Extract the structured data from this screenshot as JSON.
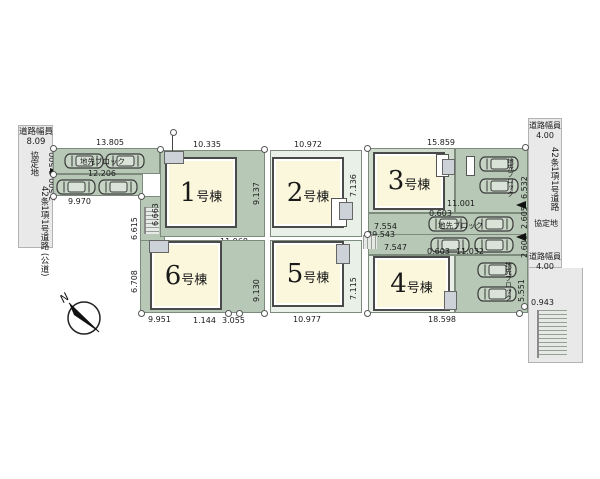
{
  "plan": {
    "compass_label": "N",
    "block_label": "地先ブロック",
    "roads": {
      "left": {
        "width_label": "道路幅員",
        "width_value": "8.09",
        "agreement": "協定地",
        "name": "42条1項1号道路",
        "name_suffix": "(公道)",
        "setback_a": "2.500",
        "setback_b": "2.500"
      },
      "right": {
        "width_label": "道路幅員",
        "width_value": "4.00",
        "agreement": "協定地",
        "name": "42条1項1号道路",
        "width_label2": "道路幅員",
        "width_value2": "4.00"
      }
    },
    "buildings": [
      {
        "num": "1",
        "suffix": "号棟"
      },
      {
        "num": "2",
        "suffix": "号棟"
      },
      {
        "num": "3",
        "suffix": "号棟"
      },
      {
        "num": "4",
        "suffix": "号棟"
      },
      {
        "num": "5",
        "suffix": "号棟"
      },
      {
        "num": "6",
        "suffix": "号棟"
      }
    ],
    "dims": {
      "park_top": "13.805",
      "park_mid": "12.206",
      "park_bottom": "9.970",
      "lot1_top": "10.335",
      "lot2_top": "10.972",
      "lot3_top": "15.859",
      "v_6663": "6.663",
      "v_6615": "6.615",
      "v_6708": "6.708",
      "v_9137": "9.137",
      "v_9130": "9.130",
      "v_7136": "7.136",
      "v_7115": "7.115",
      "lot1_bottom": "11.968",
      "lot6_bottom": "9.951",
      "seg_1144": "1.144",
      "seg_3055": "3.055",
      "lot5_bottom": "10.977",
      "lot4_bottom": "18.598",
      "d_11001": "11.001",
      "d_7554": "7.554",
      "d_29543": "29.543",
      "d_0603_a": "0.603",
      "d_0603_b": "0.603",
      "d_11032": "11.032",
      "d_7547": "7.547",
      "v_6532": "6.532",
      "v_2605": "2.605",
      "v_2606": "2.606",
      "v_5551": "5.551",
      "d_0943": "0.943"
    }
  }
}
